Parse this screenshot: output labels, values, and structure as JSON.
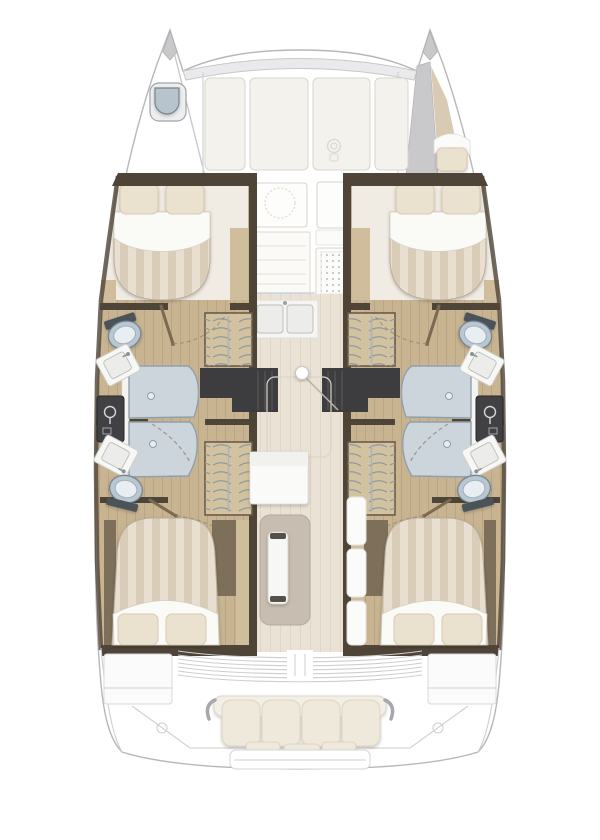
{
  "meta": {
    "title": "Catamaran interior deck plan",
    "view": "top-down floor plan",
    "orientation": "bow-up",
    "text_visible": "none"
  },
  "palette": {
    "outline": "#b7b7b9",
    "gray_band": "#c9c9cb",
    "panel": "#f4f2ed",
    "panel_edge": "#d9d5cc",
    "dark_wall": "#4e4437",
    "mid_brown": "#7d6f5a",
    "wood_light": "#cfbd9b",
    "wood_floor": "#c8b491",
    "wood_stripe": "#b9a584",
    "corridor_floor": "#e9e2d5",
    "corridor_stripe": "#ded6c7",
    "duvet_a": "#e8dfd1",
    "duvet_b": "#d9cdb9",
    "sheet": "#fafaf7",
    "pillow": "#eae1cf",
    "pillow_edge": "#d6cab4",
    "dark_steps": "#3d3d40",
    "wardrobe": "#d3c29f",
    "hanger": "#8d98a2",
    "shower_glass": "#ccd5db",
    "glass_edge": "#8fa0ab",
    "toilet_bowl": "#b9c7d2",
    "fixture_dark": "#414144",
    "table_taupe": "#c7beb1",
    "cushion": "#efe9db",
    "cushion_edge": "#dcd4c2",
    "cockpit_line": "#cfcfd1",
    "blue_strip": "#b4c6d3",
    "hatch_blue": "#b7c3cd",
    "door_arc": "#9a8c74",
    "door_leaf": "#7a6a52"
  },
  "structure": {
    "bow": {
      "port_tip": [
        "deck-hatch"
      ],
      "starboard_tip": [
        "forepeak-berth",
        "berth-cushion"
      ]
    },
    "port_hull": {
      "forward_cabin": [
        "double-berth",
        "two-pillows"
      ],
      "head": [
        "toilet-fwd",
        "washbasin-fwd",
        "shower-cabin",
        "shower-mixer-panel",
        "washbasin-aft",
        "toilet-aft",
        "hanging-locker-fwd",
        "hanging-locker-aft",
        "companionway-steps",
        "door-swing-arcs"
      ],
      "aft_cabin": [
        "double-berth",
        "two-pillows"
      ]
    },
    "starboard_hull": "mirror of port hull",
    "bridgedeck": {
      "coachroof": [
        "roof-panels",
        "winch-glyph",
        "front-crossbeam"
      ],
      "galley": [
        "round-sink-outline",
        "drawer-stack",
        "stove-grid",
        "double-sink",
        "counter"
      ],
      "salon": [
        "mast-post",
        "floor-hatch-outline",
        "mid-counter",
        "dining-table",
        "table-leaf",
        "side-cushions"
      ]
    },
    "cockpit": [
      "louvered-engine-hatch",
      "sliding-door-track",
      "side-locker-port",
      "side-locker-starboard",
      "bench-seat-cushions",
      "armrests",
      "cleats",
      "swim-platform"
    ]
  }
}
